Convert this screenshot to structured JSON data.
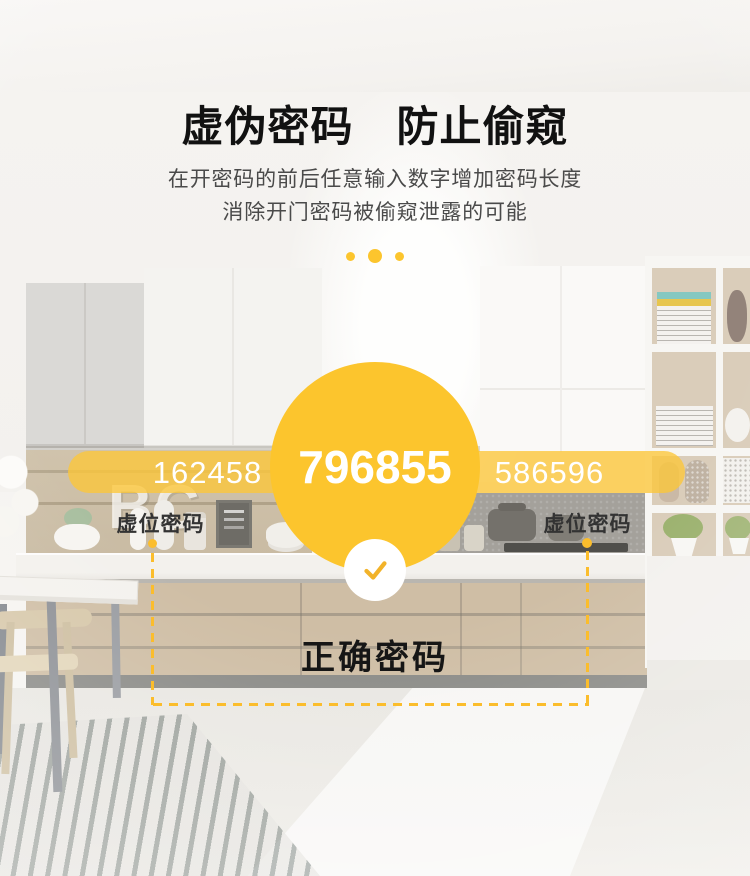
{
  "header": {
    "title": "虚伪密码　防止偷窥",
    "subtitle_line1": "在开密码的前后任意输入数字增加密码长度",
    "subtitle_line2": "消除开门密码被偷窥泄露的可能"
  },
  "demo": {
    "fake_code_left": "162458",
    "true_code": "796855",
    "fake_code_right": "586596",
    "fake_label_left": "虚位密码",
    "fake_label_right": "虚位密码",
    "true_label": "正确密码"
  },
  "background": {
    "wall_letters": "BC"
  },
  "icons": {
    "check": "checkmark"
  },
  "colors": {
    "accent_yellow": "#FCC52D",
    "bar_yellow": "rgba(252,199,56,0.78)",
    "dash_yellow": "#FBBD2C",
    "check_yellow": "#F2B32A",
    "title_color": "#111111",
    "subtitle_color": "#4A4A4A",
    "label_color": "#333333"
  }
}
